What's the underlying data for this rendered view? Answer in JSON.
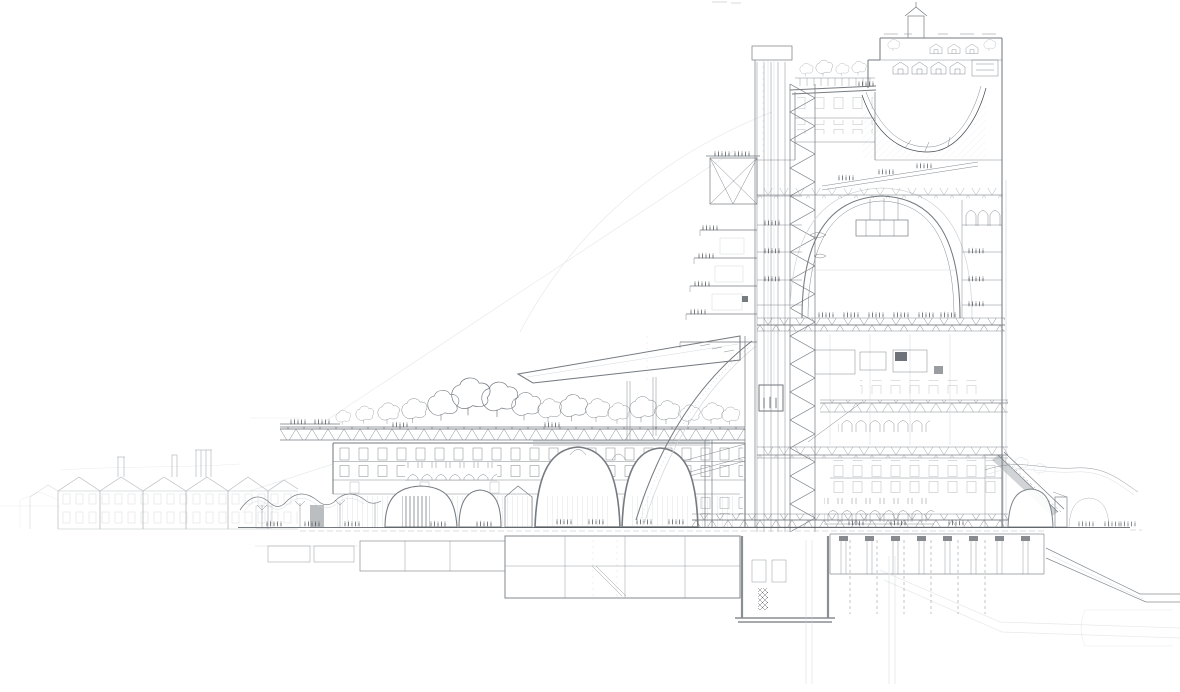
{
  "artwork": {
    "title": "Sectional perspective drawing of a layered megastructure",
    "medium": "Graphite pencil on white paper",
    "description": "Hand-drawn architectural cutaway: low gabled warehouse sheds at far left, thin-shell market canopies, a terraced podium building carried on giant catenary arches with a tree-planted truss roof garden, a cantilevered sloping auditorium wing, and a tall stacked tower cut in section with a full-height lift shaft and zig-zag stair, a grand vaulted hall full of people, a scooped rooftop garden bowl with a village of cottages on top, vaulted halls at ground level to the east, and multi-level basements, ramps and dashed pile foundations below the street datum."
  },
  "colors": {
    "background": "#ffffff",
    "paper": "#ffffff",
    "ink_dark": "#43484e",
    "ink_medium": "#757b81",
    "ink_light": "#a9afb5",
    "ink_faint": "#d0d4d7",
    "wash": "#f2f3f4"
  },
  "elements": {
    "guides": {
      "label": "Faint construction guide lines and setting-out arcs"
    },
    "warehouses": {
      "label": "Row of gabled warehouse sheds with chimneys at far left"
    },
    "canopies": {
      "label": "Thin-shell mushroom canopies over a market terrace"
    },
    "podium": {
      "label": "Terraced podium building carried on giant catenary arches"
    },
    "roof_garden": {
      "label": "Rooftop garden with trees over a steel truss deck"
    },
    "auditorium_wing": {
      "label": "Cantilevered sloping auditorium wing"
    },
    "tower": {
      "label": "Stacked vertical-city tower, cut in section"
    },
    "lift_shaft": {
      "label": "Full-height lift shaft with lift car and zig-zag escape stair"
    },
    "grand_hall": {
      "label": "Grand vaulted hall with suspended stage and crowd"
    },
    "rooftop_village": {
      "label": "Rooftop village of cottages around a scooped garden bowl"
    },
    "right_arches": {
      "label": "Ground-level vaulted halls east of the tower"
    },
    "ground": {
      "label": "Street-level datum line"
    },
    "basement": {
      "label": "Multi-level basement boxes, plant rooms and descending ramps"
    },
    "foundations": {
      "label": "Dashed pile foundations and deep piles"
    }
  }
}
